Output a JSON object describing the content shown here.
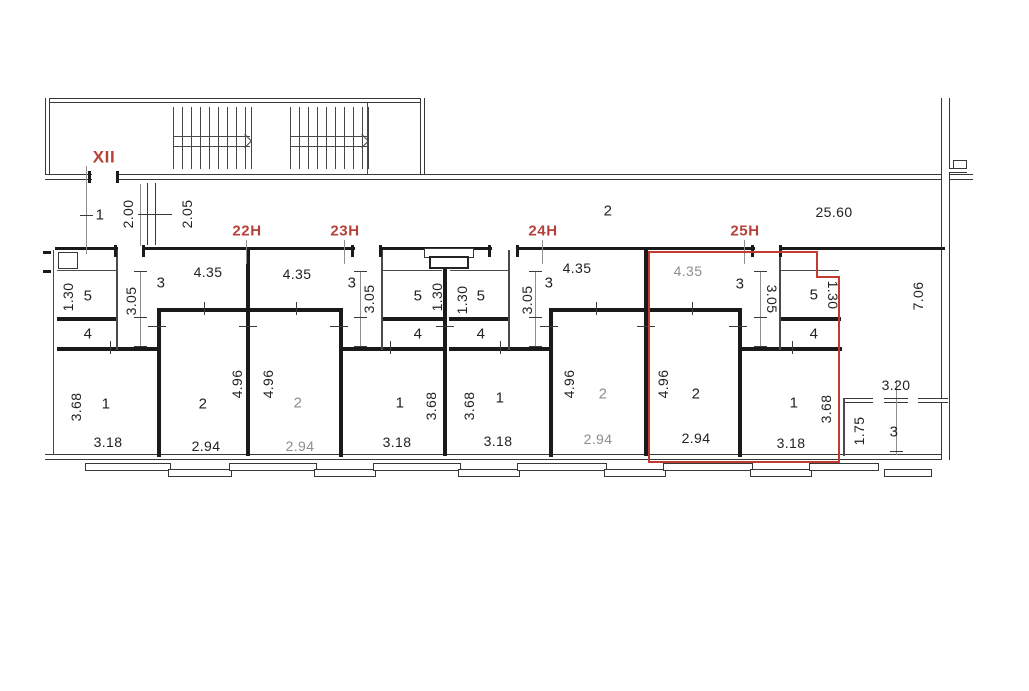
{
  "colors": {
    "accent_red": "#b5413a",
    "outline_red": "#c23b2e",
    "wall_black": "#1a1a1a",
    "gray_text": "#8e8e8e"
  },
  "stairwell": {
    "section_label": "XII"
  },
  "corridor": {
    "room_a": "1",
    "dim_a": "2.00",
    "dim_b": "2.05",
    "room_b": "2",
    "length_dim": "25.60",
    "side_dim": "7.06"
  },
  "units": [
    {
      "label": "22Н",
      "room3": "3",
      "room3_w": "4.35",
      "room3_h": "3.05",
      "room5": "5",
      "room5_h": "1.30",
      "room4": "4",
      "room1": "1",
      "room1_h": "3.68",
      "room1_w": "3.18",
      "room2": "2",
      "room2_h": "4.96",
      "room2_w": "2.94"
    },
    {
      "label": "23Н",
      "room3": "3",
      "room3_w": "4.35",
      "room3_h": "3.05",
      "room5": "5",
      "room5_h": "1.30",
      "room4": "4",
      "room1": "1",
      "room1_h": "3.68",
      "room1_w": "3.18",
      "room2": "2",
      "room2_h": "4.96",
      "room2_w": "2.94"
    },
    {
      "label": "24Н",
      "room3": "3",
      "room3_w": "4.35",
      "room3_h": "3.05",
      "room5": "5",
      "room5_h": "1.30",
      "room4": "4",
      "room1": "1",
      "room1_h": "3.68",
      "room1_w": "3.18",
      "room2": "2",
      "room2_h": "4.96",
      "room2_w": "2.94"
    },
    {
      "label": "25Н",
      "room3": "3",
      "room3_w": "4.35",
      "room3_h": "3.05",
      "room5": "5",
      "room5_h": "1.30",
      "room4": "4",
      "room1": "1",
      "room1_h": "3.68",
      "room1_w": "3.18",
      "room2": "2",
      "room2_h": "4.96",
      "room2_w": "2.94"
    }
  ],
  "annex": {
    "room": "3",
    "width_dim": "3.20",
    "height_dim": "1.75"
  }
}
